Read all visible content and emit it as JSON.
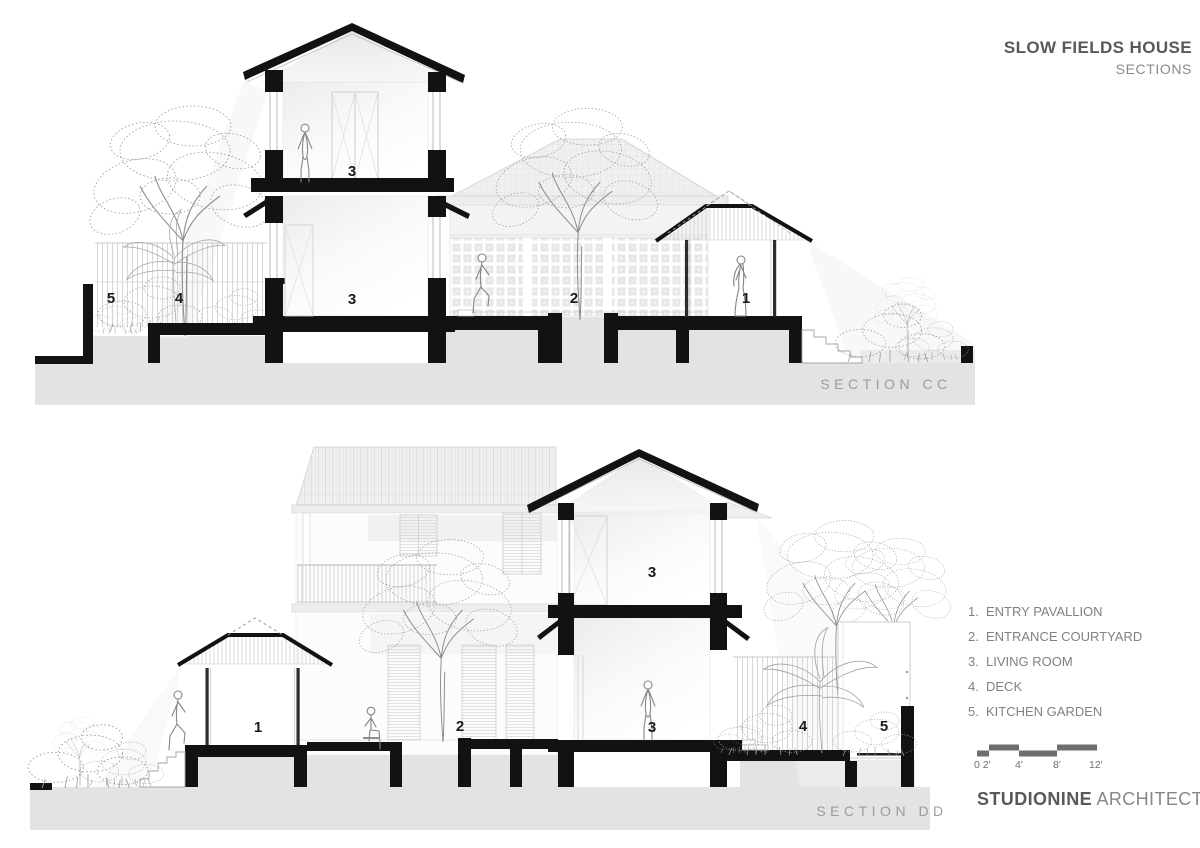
{
  "title_block": {
    "project": "SLOW FIELDS HOUSE",
    "sheet": "SECTIONS"
  },
  "sections": [
    {
      "id": "CC",
      "label": "SECTION CC",
      "callouts": {
        "kitchen_garden": "5",
        "deck": "4",
        "living_upper": "3",
        "living_lower": "3",
        "entrance_courtyard": "2",
        "entry_pavilion": "1"
      }
    },
    {
      "id": "DD",
      "label": "SECTION DD",
      "callouts": {
        "entry_pavilion": "1",
        "entrance_courtyard": "2",
        "living_upper": "3",
        "living_lower": "3",
        "deck": "4",
        "kitchen_garden": "5"
      }
    }
  ],
  "legend": {
    "items": [
      {
        "number": "1.",
        "label": "ENTRY PAVALLION"
      },
      {
        "number": "2.",
        "label": "ENTRANCE COURTYARD"
      },
      {
        "number": "3.",
        "label": "LIVING ROOM"
      },
      {
        "number": "4.",
        "label": "DECK"
      },
      {
        "number": "5.",
        "label": "KITCHEN GARDEN"
      }
    ]
  },
  "scale_bar": {
    "ticks": [
      "0 2'",
      "4'",
      "8'",
      "12'"
    ]
  },
  "firm": {
    "name": "STUDIONINE",
    "suffix": "ARCHITECTS"
  },
  "colors": {
    "ink": "#121212",
    "ground": "#e3e3e3",
    "callout": "#1a1a1a",
    "section_label": "#9b9c9e",
    "title": "#58595b",
    "subtitle": "#8a8b8d",
    "legend_text": "#808184",
    "scale": "#6d6e70",
    "firm_name": "#58595b",
    "firm_suffix": "#85878a"
  }
}
